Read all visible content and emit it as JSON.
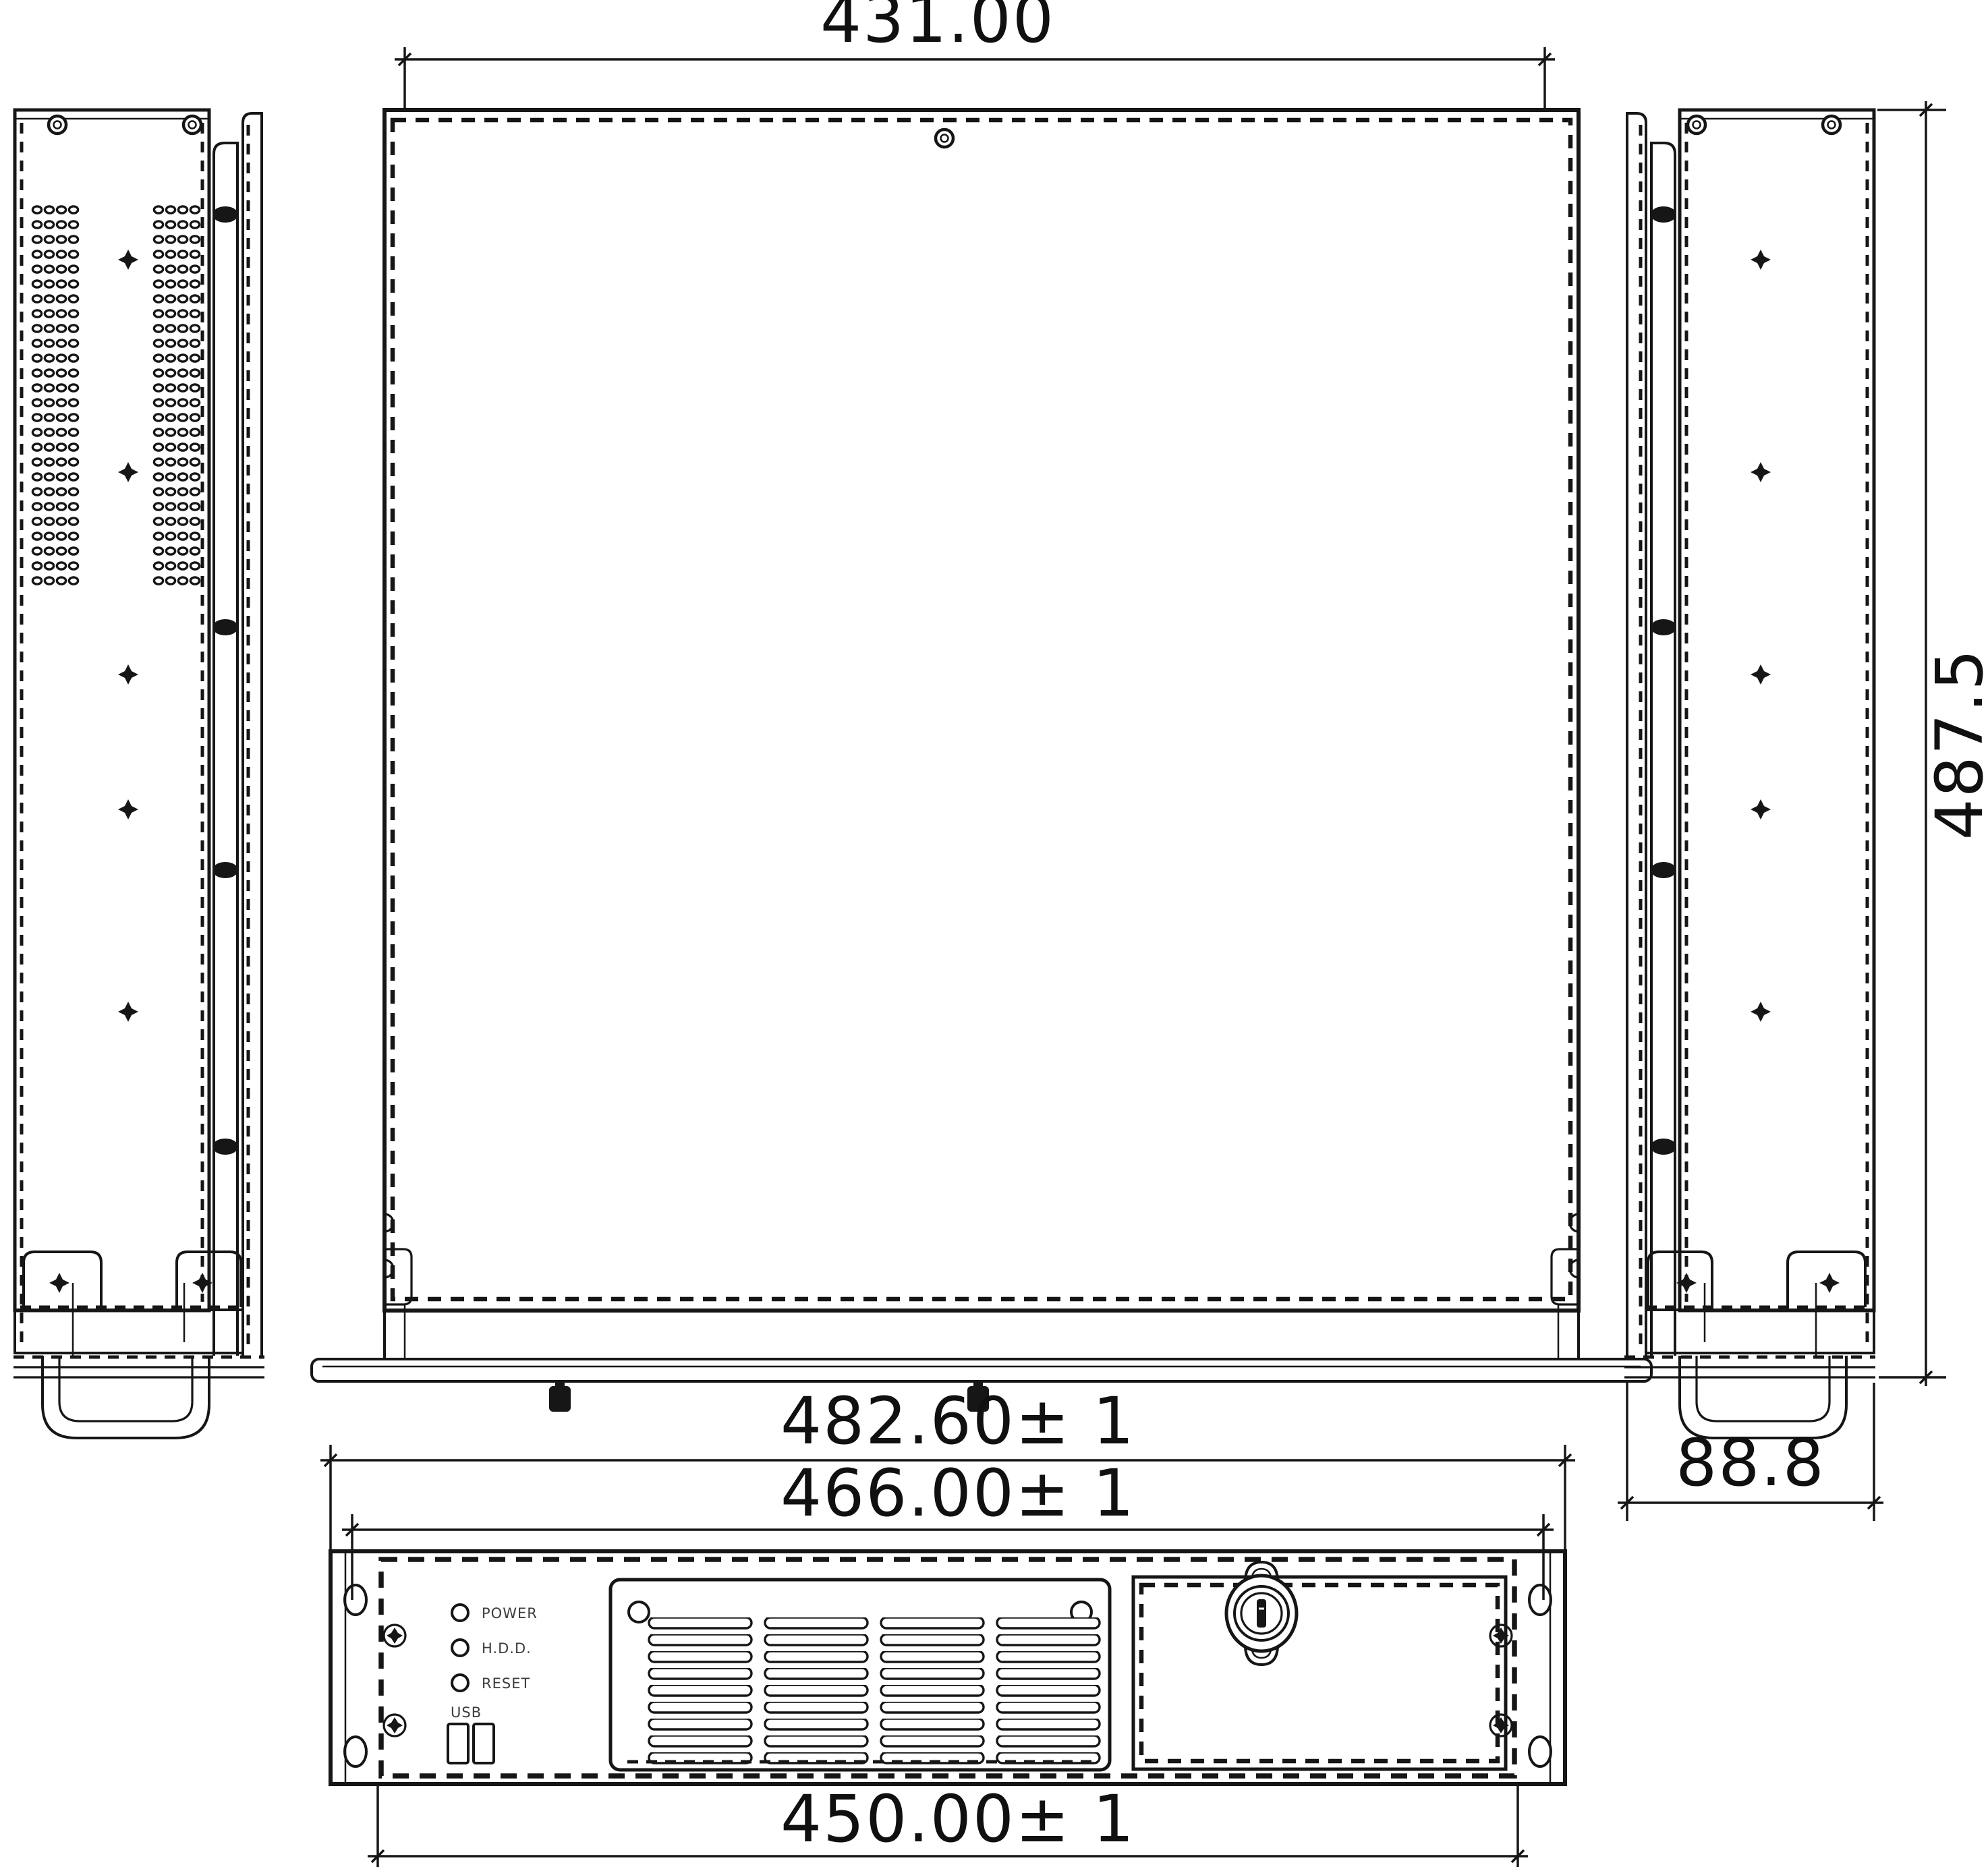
{
  "drawing": {
    "stroke_color": "#161616",
    "background": "#ffffff",
    "dimensions": {
      "top_view_width": "431.00",
      "side_view_height": "487.5",
      "side_view_depth": "88.8",
      "front_flange_width": "482.60± 1",
      "front_mount_width": "466.00± 1",
      "front_body_width": "450.00± 1"
    },
    "front_panel": {
      "led_labels": [
        "POWER",
        "H.D.D.",
        "RESET"
      ],
      "usb_label": "USB"
    }
  }
}
